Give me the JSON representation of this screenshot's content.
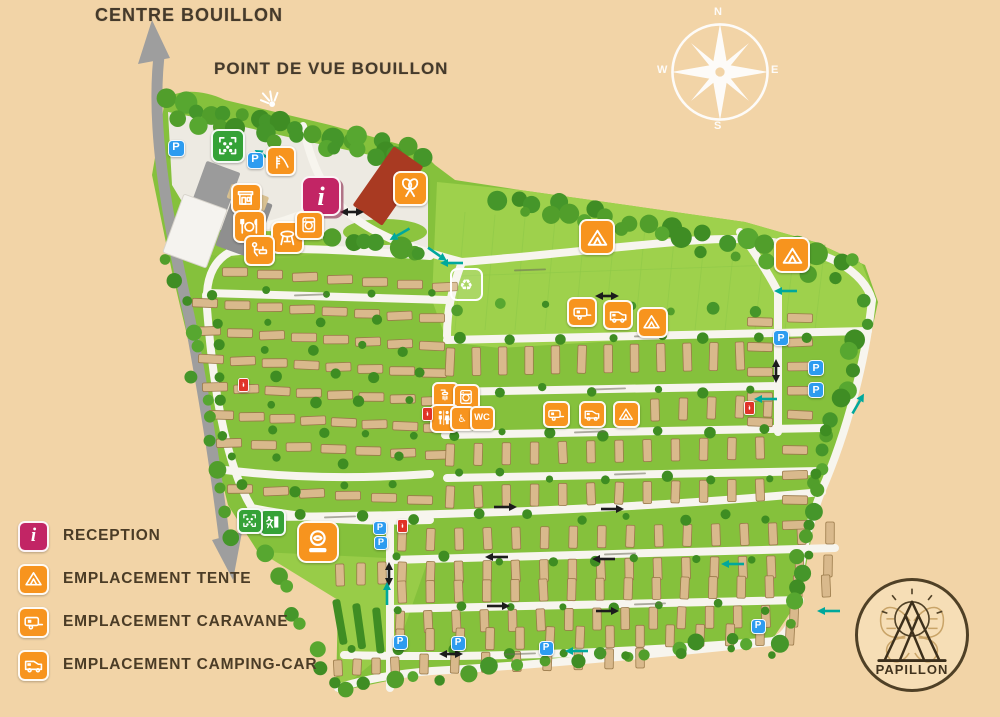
{
  "labels": {
    "centre": "CENTRE BOUILLON",
    "viewpoint": "POINT DE VUE BOUILLON"
  },
  "compass": {
    "n": "N",
    "e": "E",
    "s": "S",
    "w": "W"
  },
  "legend": {
    "items": [
      {
        "icon": "reception",
        "label": "RECEPTION"
      },
      {
        "icon": "tent",
        "label": "EMPLACEMENT TENTE"
      },
      {
        "icon": "caravan",
        "label": "EMPLACEMENT CARAVANE"
      },
      {
        "icon": "campingcar",
        "label": "EMPLACEMENT CAMPING-CAR"
      }
    ]
  },
  "logo": {
    "name": "PAPILLON"
  },
  "colors": {
    "background": "#f2d4a7",
    "field": "#85c13c",
    "meadow": "#9ed14c",
    "orange": "#f7941e",
    "pink": "#c22565",
    "blue": "#2d9cf0",
    "green_icon": "#35a237",
    "red": "#e03328",
    "teal": "#00a89c",
    "road": "#f7f5ee",
    "grey_road": "#9e9e9e",
    "pitch": "#d9b98c",
    "text": "#46392a"
  },
  "markers": [
    {
      "name": "parking",
      "type": "parking",
      "text": "P",
      "x": 176,
      "y": 148,
      "s": 17
    },
    {
      "name": "parking",
      "type": "parking",
      "text": "P",
      "x": 255,
      "y": 160,
      "s": 17
    },
    {
      "name": "parking",
      "type": "parking",
      "text": "P",
      "x": 781,
      "y": 338,
      "s": 16
    },
    {
      "name": "parking",
      "type": "parking",
      "text": "P",
      "x": 816,
      "y": 368,
      "s": 16
    },
    {
      "name": "parking",
      "type": "parking",
      "text": "P",
      "x": 816,
      "y": 390,
      "s": 16
    },
    {
      "name": "parking",
      "type": "parking",
      "text": "P",
      "x": 380,
      "y": 528,
      "s": 14
    },
    {
      "name": "parking",
      "type": "parking",
      "text": "P",
      "x": 381,
      "y": 543,
      "s": 14
    },
    {
      "name": "parking",
      "type": "parking",
      "text": "P",
      "x": 400,
      "y": 642,
      "s": 15
    },
    {
      "name": "parking",
      "type": "parking",
      "text": "P",
      "x": 458,
      "y": 643,
      "s": 15
    },
    {
      "name": "parking",
      "type": "parking",
      "text": "P",
      "x": 546,
      "y": 648,
      "s": 15
    },
    {
      "name": "parking",
      "type": "parking",
      "text": "P",
      "x": 758,
      "y": 626,
      "s": 15
    },
    {
      "name": "reception",
      "type": "reception",
      "text": "i",
      "x": 321,
      "y": 196,
      "s": 40
    },
    {
      "name": "playground",
      "type": "play-area",
      "x": 228,
      "y": 146,
      "s": 34
    },
    {
      "name": "slide",
      "type": "slide",
      "x": 281,
      "y": 161,
      "s": 30
    },
    {
      "name": "shop",
      "type": "shop",
      "x": 246,
      "y": 198,
      "s": 31
    },
    {
      "name": "restaurant",
      "type": "restaurant",
      "x": 249,
      "y": 226,
      "s": 33
    },
    {
      "name": "bbq",
      "type": "bbq",
      "x": 287,
      "y": 237,
      "s": 33
    },
    {
      "name": "dishwashing",
      "type": "washup",
      "x": 259,
      "y": 250,
      "s": 31
    },
    {
      "name": "laundry",
      "type": "laundry",
      "x": 309,
      "y": 225,
      "s": 29
    },
    {
      "name": "badminton",
      "type": "rackets",
      "x": 410,
      "y": 188,
      "s": 35
    },
    {
      "name": "recycling-point",
      "type": "recycle",
      "x": 466,
      "y": 284,
      "s": 33
    },
    {
      "name": "shower",
      "type": "shower",
      "x": 445,
      "y": 395,
      "s": 27
    },
    {
      "name": "laundry",
      "type": "laundry",
      "x": 466,
      "y": 397,
      "s": 27
    },
    {
      "name": "toilets",
      "type": "toilets",
      "x": 444,
      "y": 418,
      "s": 29
    },
    {
      "name": "accessible-toilet",
      "type": "wheelchair",
      "x": 462,
      "y": 418,
      "s": 25
    },
    {
      "name": "wc",
      "type": "wc",
      "text": "WC",
      "x": 482,
      "y": 418,
      "s": 25
    },
    {
      "name": "tent-zone",
      "type": "tent",
      "x": 597,
      "y": 237,
      "s": 36
    },
    {
      "name": "tent-zone",
      "type": "tent",
      "x": 792,
      "y": 255,
      "s": 36
    },
    {
      "name": "tent-zone",
      "type": "tent",
      "x": 652,
      "y": 322,
      "s": 31
    },
    {
      "name": "tent-zone",
      "type": "tent",
      "x": 626,
      "y": 414,
      "s": 27
    },
    {
      "name": "caravan-zone",
      "type": "caravan",
      "x": 582,
      "y": 312,
      "s": 30
    },
    {
      "name": "caravan-zone",
      "type": "caravan",
      "x": 556,
      "y": 414,
      "s": 27
    },
    {
      "name": "campingcar-zone",
      "type": "campingcar",
      "x": 618,
      "y": 315,
      "s": 30
    },
    {
      "name": "campingcar-zone",
      "type": "campingcar",
      "x": 592,
      "y": 414,
      "s": 27
    },
    {
      "name": "fire-point",
      "type": "fire",
      "x": 429,
      "y": 414,
      "s": 14
    },
    {
      "name": "fire-point",
      "type": "fire",
      "x": 245,
      "y": 385,
      "s": 14
    },
    {
      "name": "fire-point",
      "type": "fire",
      "x": 751,
      "y": 408,
      "s": 14
    },
    {
      "name": "fire-point",
      "type": "fire",
      "x": 404,
      "y": 526,
      "s": 14
    },
    {
      "name": "emergency-exit",
      "type": "exit",
      "x": 272,
      "y": 522,
      "s": 27
    },
    {
      "name": "meeting-point",
      "type": "meeting",
      "x": 250,
      "y": 521,
      "s": 26
    },
    {
      "name": "activity-area",
      "type": "activity",
      "x": 318,
      "y": 542,
      "s": 42
    },
    {
      "name": "viewpoint",
      "type": "viewpoint",
      "x": 270,
      "y": 100,
      "s": 30
    }
  ]
}
